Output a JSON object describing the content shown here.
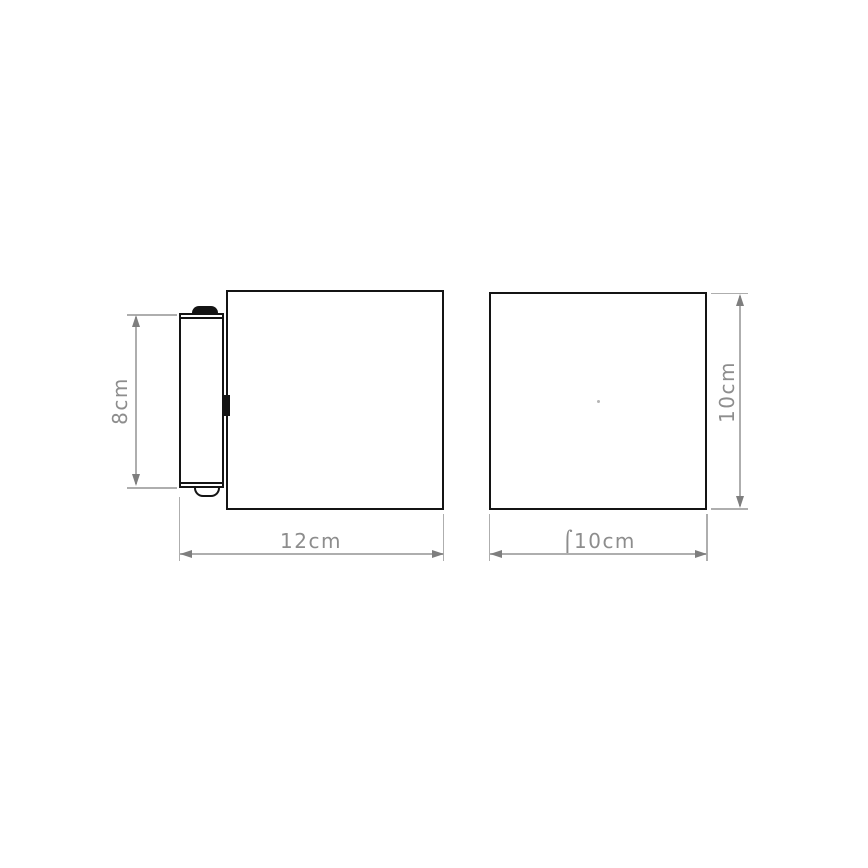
{
  "diagram": {
    "kind": "product-dimension-drawing",
    "views": {
      "side": {
        "name": "side view with wall-mount plate",
        "plate_height": {
          "label": "8cm",
          "value": 8,
          "unit": "cm"
        },
        "depth": {
          "label": "12cm",
          "value": 12,
          "unit": "cm"
        }
      },
      "front": {
        "name": "front view",
        "height": {
          "label": "10cm",
          "value": 10,
          "unit": "cm"
        },
        "diameter": {
          "label": "⌠10cm",
          "value": 10,
          "unit": "cm",
          "is_diameter": true
        }
      }
    },
    "colors": {
      "background": "#ffffff",
      "outline": "#141414",
      "dimension_line": "#aeaeae",
      "dimension_arrow": "#7e7e7e",
      "dimension_text": "#8d8d8d"
    }
  }
}
